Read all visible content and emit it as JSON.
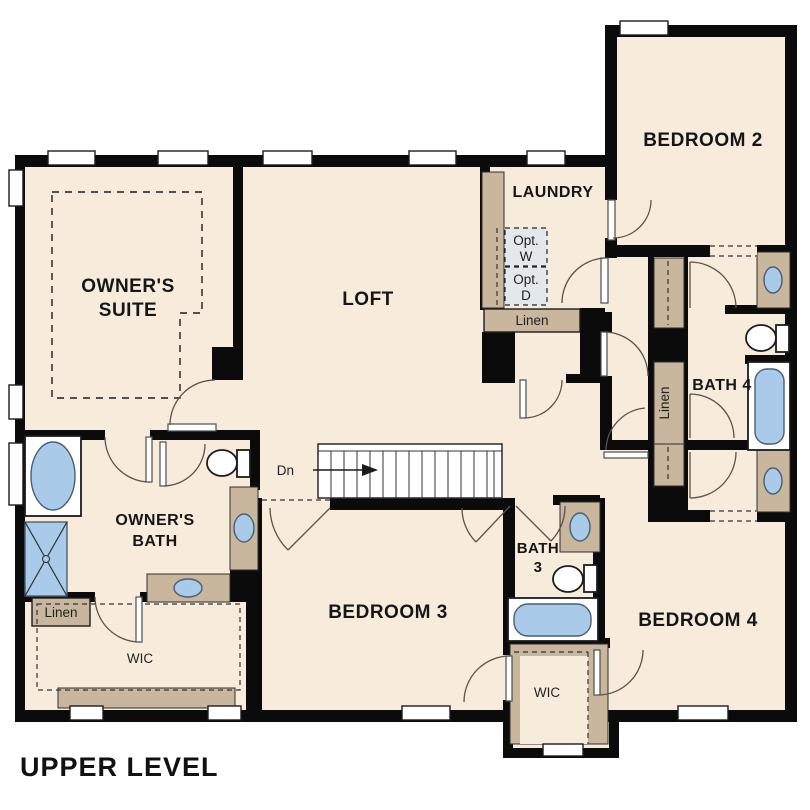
{
  "plan_title": "UPPER LEVEL",
  "labels": {
    "owners_suite_1": "OWNER'S",
    "owners_suite_2": "SUITE",
    "loft": "LOFT",
    "laundry": "LAUNDRY",
    "bedroom2": "BEDROOM 2",
    "bedroom3": "BEDROOM 3",
    "bedroom4": "BEDROOM 4",
    "bath4": "BATH 4",
    "bath3_1": "BATH",
    "bath3_2": "3",
    "owners_bath_1": "OWNER'S",
    "owners_bath_2": "BATH",
    "wic_owners": "WIC",
    "wic_center": "WIC",
    "linen_laundry": "Linen",
    "linen_owners": "Linen",
    "linen_hall": "Linen",
    "opt_w_1": "Opt.",
    "opt_w_2": "W",
    "opt_d_1": "Opt.",
    "opt_d_2": "D",
    "stairs_down": "Dn"
  },
  "colors": {
    "floor": "#f7ecdc",
    "wall": "#0b0b0b",
    "counter_tan": "#c8b79d",
    "fixture_blue": "#a9cbe9",
    "optional_fill": "#e3e8ec",
    "background": "#ffffff"
  }
}
